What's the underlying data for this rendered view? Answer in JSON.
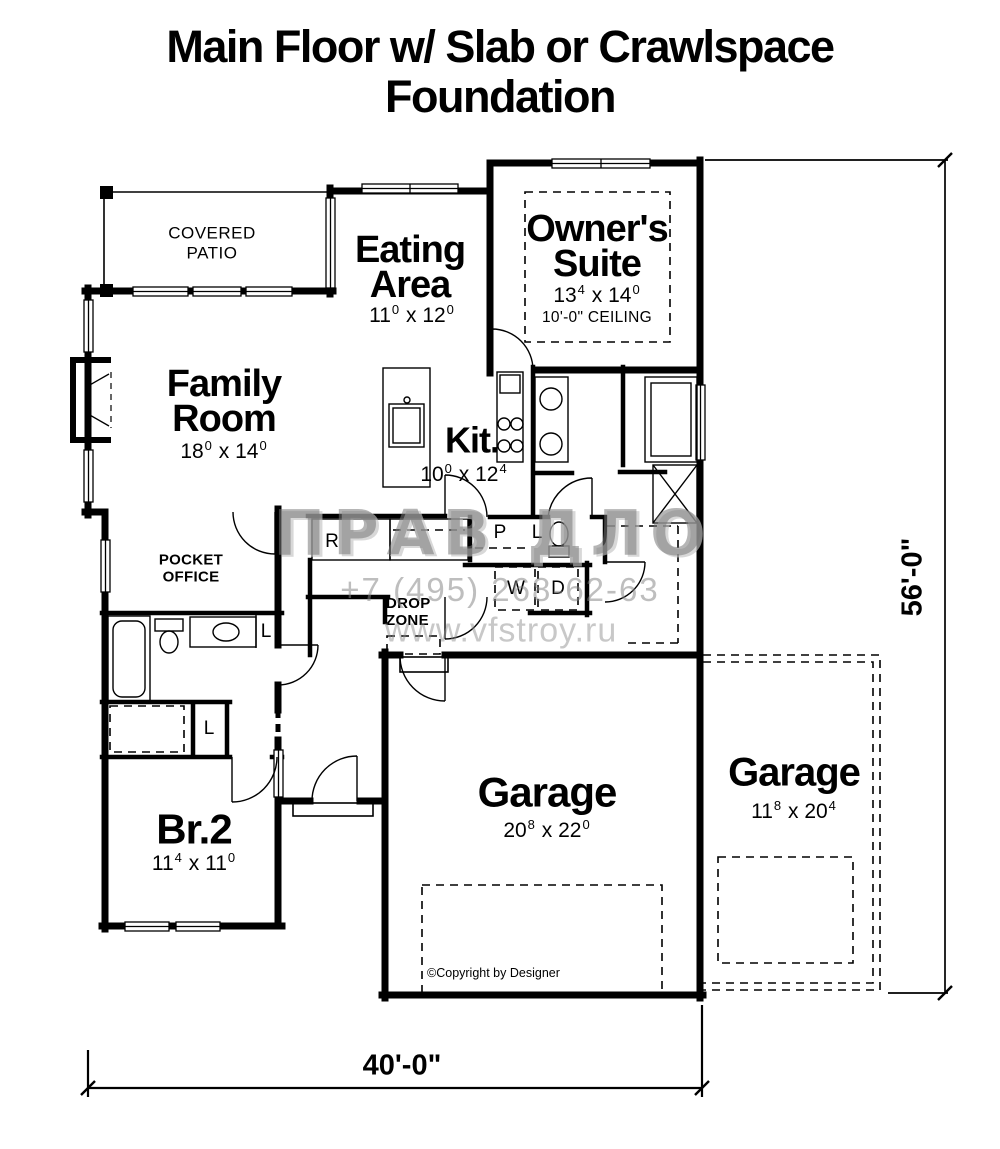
{
  "title": {
    "line1": "Main Floor w/ Slab or Crawlspace",
    "line2": "Foundation"
  },
  "rooms": {
    "covered_patio": {
      "l1": "COVERED",
      "l2": "PATIO"
    },
    "eating": {
      "l1": "Eating",
      "l2": "Area",
      "dim": {
        "w": "11",
        "ws": "0",
        "sep": "x",
        "h": "12",
        "hs": "0"
      }
    },
    "owners": {
      "l1": "Owner's",
      "l2": "Suite",
      "dim": {
        "w": "13",
        "ws": "4",
        "sep": "x",
        "h": "14",
        "hs": "0"
      },
      "ceiling": "10'-0\" CEILING"
    },
    "family": {
      "l1": "Family",
      "l2": "Room",
      "dim": {
        "w": "18",
        "ws": "0",
        "sep": "x",
        "h": "14",
        "hs": "0"
      }
    },
    "kitchen": {
      "name": "Kit.",
      "dim": {
        "w": "10",
        "ws": "0",
        "sep": "x",
        "h": "12",
        "hs": "4"
      }
    },
    "pocket_office": {
      "l1": "POCKET",
      "l2": "OFFICE"
    },
    "drop_zone": {
      "l1": "DROP",
      "l2": "ZONE"
    },
    "br2": {
      "name": "Br.2",
      "dim": {
        "w": "11",
        "ws": "4",
        "sep": "x",
        "h": "11",
        "hs": "0"
      }
    },
    "garage_main": {
      "name": "Garage",
      "dim": {
        "w": "20",
        "ws": "8",
        "sep": "x",
        "h": "22",
        "hs": "0"
      }
    },
    "garage_opt": {
      "name": "Garage",
      "dim": {
        "w": "11",
        "ws": "8",
        "sep": "x",
        "h": "20",
        "hs": "4"
      }
    }
  },
  "fixtures": {
    "fridge": "R",
    "pantry": "P",
    "linen_powder": "L",
    "washer": "W",
    "dryer": "D",
    "linen_bath": "L",
    "linen_closet": "L"
  },
  "dimensions": {
    "width": "40'-0\"",
    "height": "56'-0\""
  },
  "copyright": "©Copyright by Designer",
  "watermark": {
    "logo": "ПРАВ ДЛО",
    "phone": "+7 (495) 268-62-63",
    "site": "www.vfstroy.ru"
  },
  "colors": {
    "wall": "#000000",
    "watermark_gray": "#8a8a8a"
  }
}
